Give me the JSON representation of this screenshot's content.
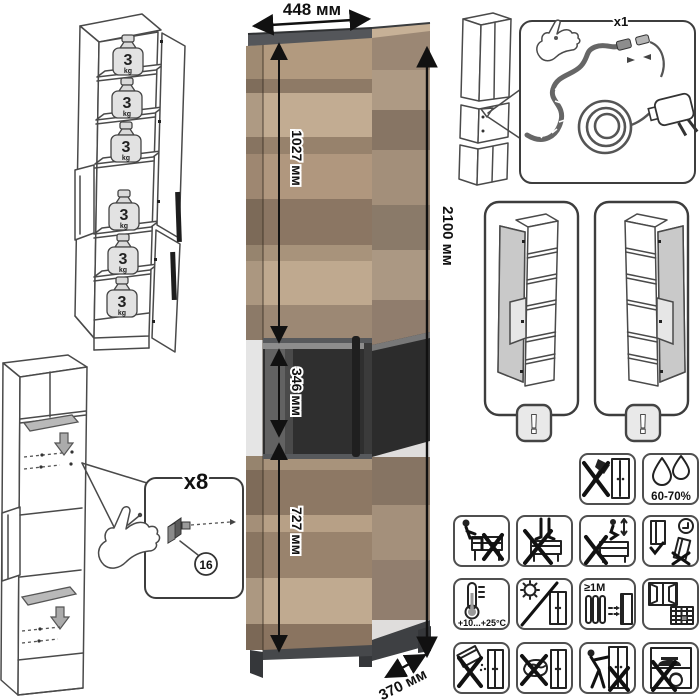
{
  "dimensions": {
    "width": "448 мм",
    "height": "2100 мм",
    "depth": "370 мм",
    "upper_section": "1027 мм",
    "glass_section": "346 мм",
    "lower_section": "727 мм"
  },
  "shelf_load": {
    "value": "3",
    "unit": "kg",
    "shelf_count": 6
  },
  "assembly": {
    "fastener_quantity": "x8",
    "part_number": "16"
  },
  "lighting_kit": {
    "quantity": "x1"
  },
  "door_variants": {
    "warning": "!",
    "options": [
      "left-hinged",
      "right-hinged"
    ]
  },
  "care": {
    "humidity": "60-70%",
    "temperature": "+10...+25°C",
    "min_distance": "≥1М"
  },
  "icons": {
    "care_grid": [
      "no-cutting-tools-icon",
      "humidity-icon",
      "no-sitting-icon",
      "no-standing-icon",
      "no-jumping-icon",
      "door-adjust-icon",
      "temperature-range-icon",
      "no-direct-sunlight-icon",
      "radiator-distance-icon",
      "ventilation-icon",
      "no-abrasive-powder-icon",
      "no-abrasive-sponge-icon",
      "no-dragging-icon",
      "no-overload-icon"
    ]
  },
  "colors": {
    "wood_light": "#c2ac92",
    "wood_mid": "#ab947c",
    "wood_dark": "#8b7663",
    "frame_dark": "#4a4c4e",
    "glass_dark": "#2c2c2c",
    "line_art": "#4a4a4a",
    "shelf_gray": "#b9b9b9"
  }
}
